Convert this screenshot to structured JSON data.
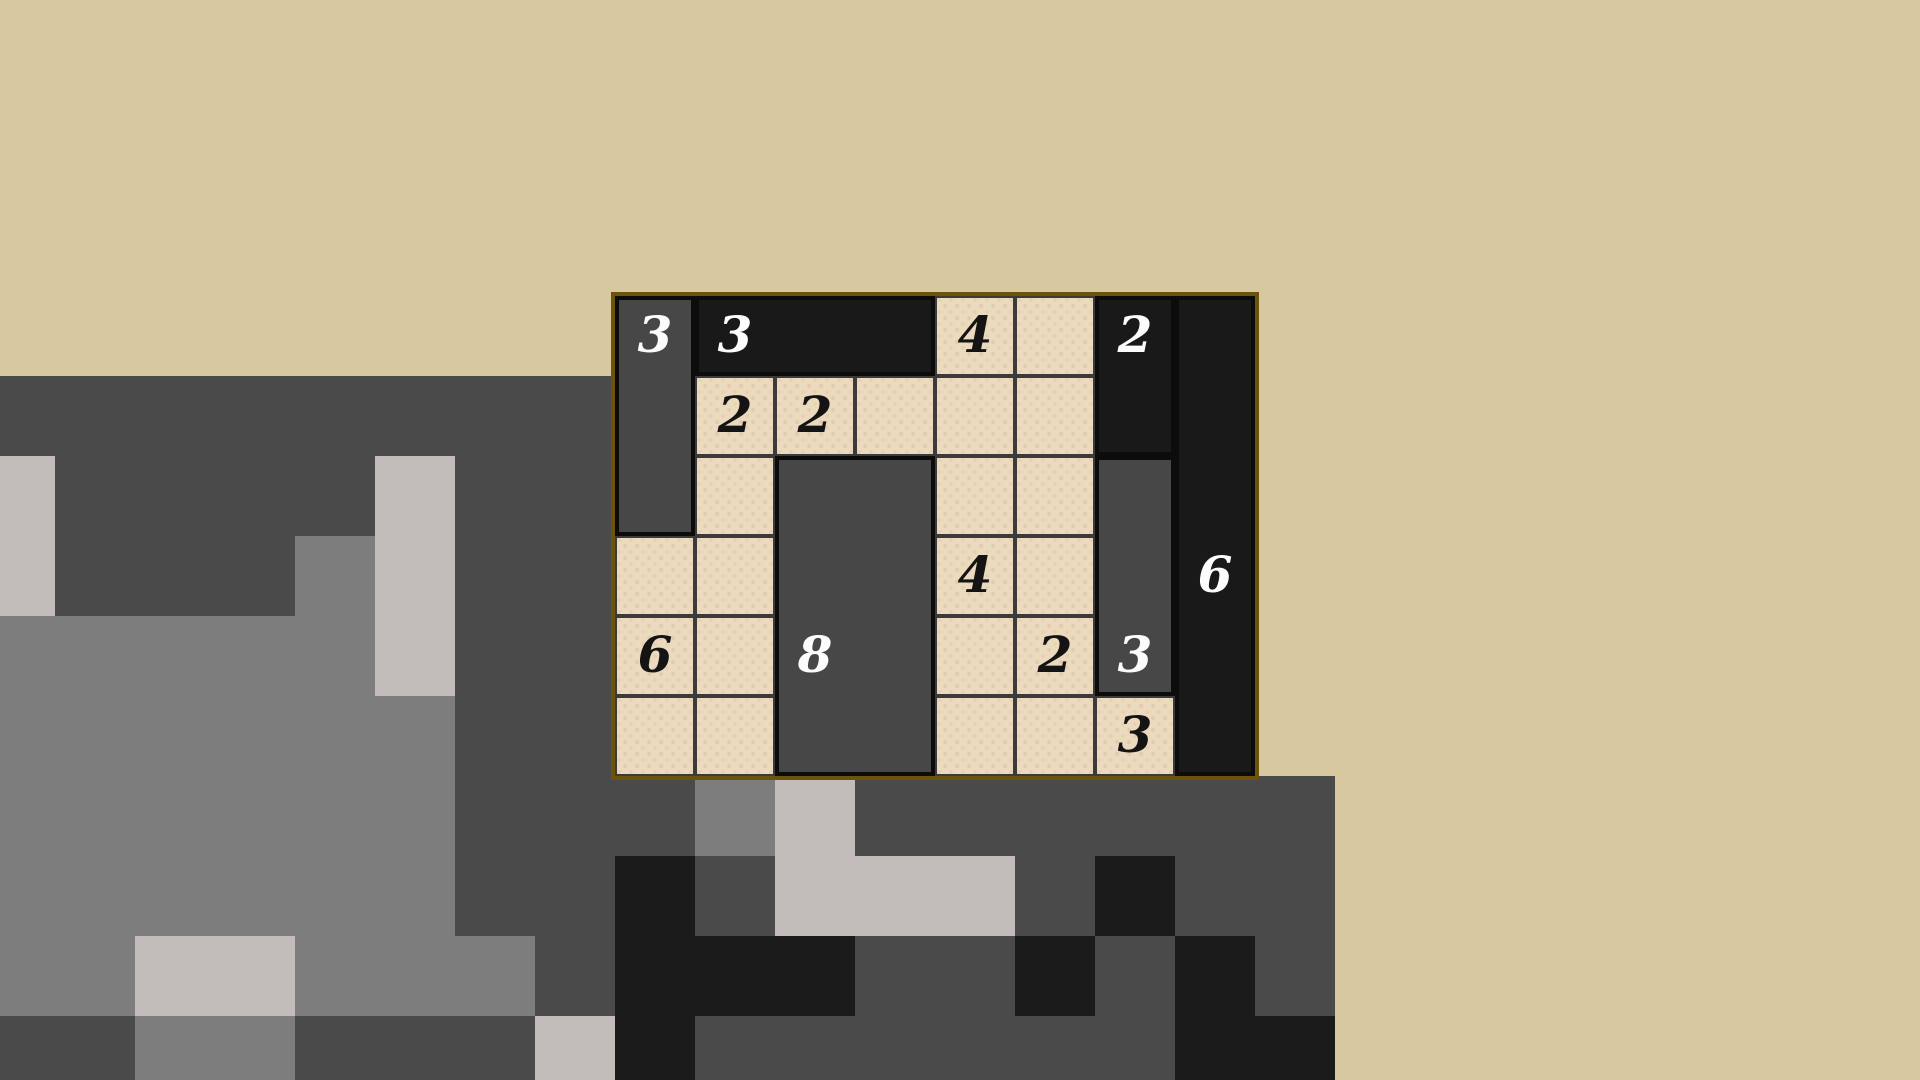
{
  "page": {
    "width": 1920,
    "height": 1080,
    "background_color": "#d7c8a0"
  },
  "puzzle": {
    "left": 611,
    "top": 292,
    "cols": 8,
    "rows": 6,
    "cell_size": 80,
    "border_color": "#6b530b",
    "border_width": 4,
    "cell_color": "#ecdabf",
    "grid_line_color": "#3b3b3b",
    "rect_border_color": "#0c0c0c",
    "shade_colors": {
      "dark": "#474747",
      "black": "#191919"
    },
    "number_color_on_rect": "#fcfcfc",
    "number_color_on_cell": "#141414",
    "rectangles": [
      {
        "col": 1,
        "row": 1,
        "w": 1,
        "h": 3,
        "shade": "dark",
        "value": "3",
        "value_col": 1,
        "value_row": 1
      },
      {
        "col": 2,
        "row": 1,
        "w": 3,
        "h": 1,
        "shade": "black",
        "value": "3",
        "value_col": 2,
        "value_row": 1
      },
      {
        "col": 7,
        "row": 1,
        "w": 1,
        "h": 2,
        "shade": "black",
        "value": "2",
        "value_col": 7,
        "value_row": 1
      },
      {
        "col": 8,
        "row": 1,
        "w": 1,
        "h": 6,
        "shade": "black",
        "value": "6",
        "value_col": 8,
        "value_row": 4
      },
      {
        "col": 3,
        "row": 3,
        "w": 2,
        "h": 4,
        "shade": "dark",
        "value": "8",
        "value_col": 3,
        "value_row": 5
      },
      {
        "col": 7,
        "row": 3,
        "w": 1,
        "h": 3,
        "shade": "dark",
        "value": "3",
        "value_col": 7,
        "value_row": 5
      }
    ],
    "clues": [
      {
        "col": 5,
        "row": 1,
        "value": "4"
      },
      {
        "col": 2,
        "row": 2,
        "value": "2"
      },
      {
        "col": 3,
        "row": 2,
        "value": "2"
      },
      {
        "col": 5,
        "row": 4,
        "value": "4"
      },
      {
        "col": 1,
        "row": 5,
        "value": "6"
      },
      {
        "col": 6,
        "row": 5,
        "value": "2"
      },
      {
        "col": 7,
        "row": 6,
        "value": "3"
      }
    ]
  },
  "background_pattern": {
    "origin_x": -25,
    "origin_y": 296,
    "cell_size": 80,
    "legend": {
      "t": "transparent",
      "d": "#4a4a4a",
      "m": "#7d7d7d",
      "l": "#c2bdba",
      "b": "#1b1b1b"
    },
    "rows": [
      "ttttttttttttttttt",
      "ddddddddttttttttt",
      "lddddlddttttttttt",
      "ldddmlddttttttttt",
      "mmmmmlddttttttttt",
      "mmmmmmddttttttttt",
      "mmmmmmdddmldddddd",
      "mmmmmmddbdllldbdd",
      "mmllmmmdbbbddbdbd",
      "ddmmdddlbddddddbb"
    ]
  }
}
